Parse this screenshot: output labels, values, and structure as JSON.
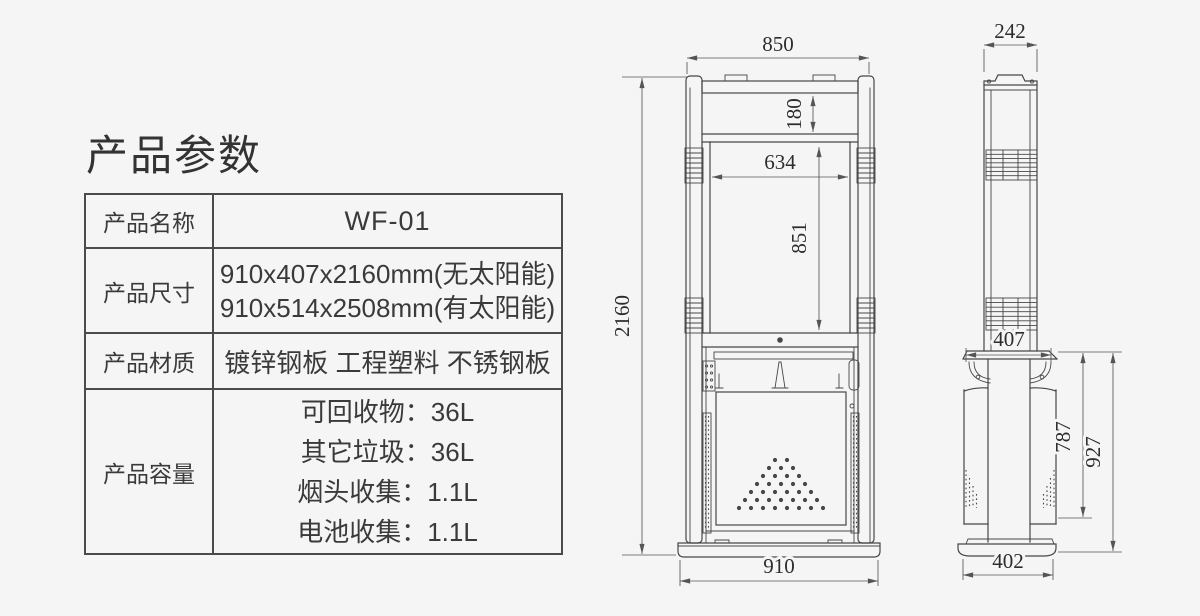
{
  "title": "产品参数",
  "colors": {
    "background": "#f5f5f5",
    "line": "#474747",
    "text": "#3a3a3a"
  },
  "table": {
    "rows": [
      {
        "label": "产品名称",
        "values": [
          "WF-01"
        ]
      },
      {
        "label": "产品尺寸",
        "values": [
          "910x407x2160mm(无太阳能)",
          "910x514x2508mm(有太阳能)"
        ]
      },
      {
        "label": "产品材质",
        "values": [
          "镀锌钢板 工程塑料 不锈钢板"
        ]
      },
      {
        "label": "产品容量",
        "values": [
          "可回收物：36L",
          "其它垃圾：36L",
          "烟头收集：1.1L",
          "电池收集：1.1L"
        ]
      }
    ]
  },
  "drawing": {
    "front_view": {
      "dim_top_width": "850",
      "dim_header_height": "180",
      "dim_screen_width": "634",
      "dim_screen_height": "851",
      "dim_total_height": "2160",
      "dim_base_width": "910"
    },
    "side_view": {
      "dim_top_depth": "242",
      "dim_body_depth": "407",
      "dim_bin_height": "787",
      "dim_lower_height": "927",
      "dim_base_depth": "402"
    }
  }
}
